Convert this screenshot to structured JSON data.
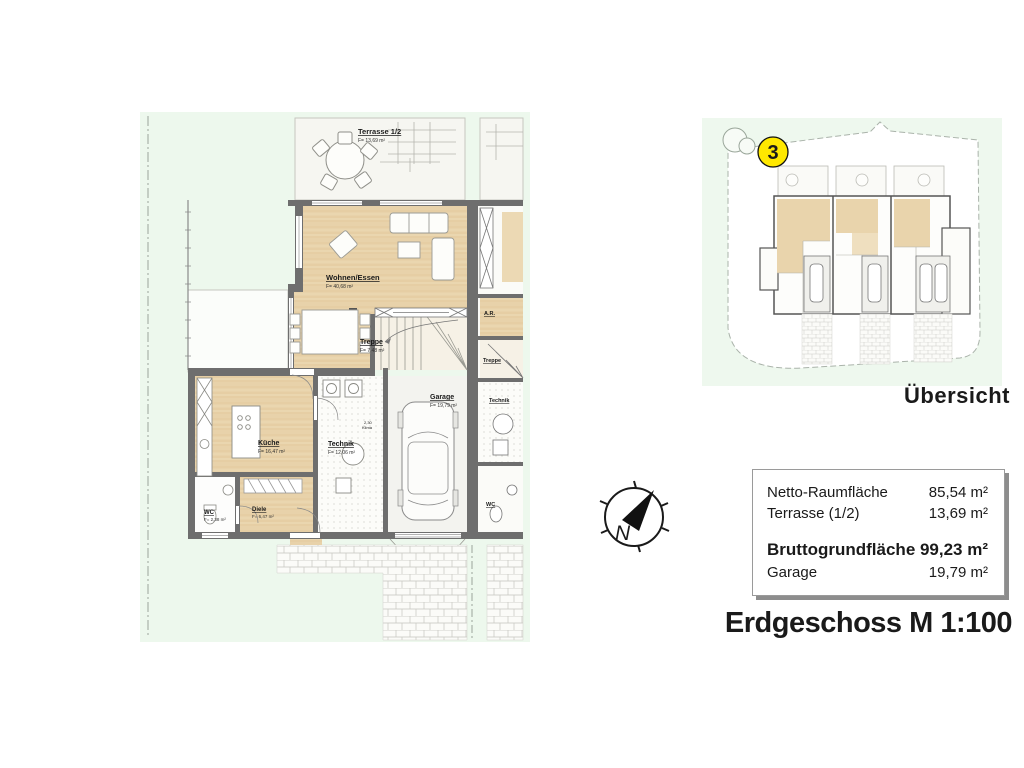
{
  "title": "Erdgeschoss M 1:100",
  "overview": {
    "badge": "3",
    "label": "Übersicht"
  },
  "compass": {
    "letter": "N"
  },
  "summary": {
    "rows": [
      {
        "label": "Netto-Raumfläche",
        "value": "85,54 m²"
      },
      {
        "label": "Terrasse (1/2)",
        "value": "13,69 m²"
      }
    ],
    "total": {
      "label": "Bruttogrundfläche",
      "value": "99,23 m²"
    },
    "garage": {
      "label": "Garage",
      "value": "19,79 m²"
    }
  },
  "floorplan": {
    "terrasse": {
      "name": "Terrasse 1/2",
      "area": "F= 13,69 m²"
    },
    "wohnen": {
      "name": "Wohnen/Essen",
      "area": "F= 40,68 m²"
    },
    "treppe": {
      "name": "Treppe",
      "area": "F= 7,48 m²"
    },
    "kueche": {
      "name": "Küche",
      "area": "F= 16,47 m²"
    },
    "technik": {
      "name": "Technik",
      "area": "F= 12,06 m²"
    },
    "garage": {
      "name": "Garage",
      "area": "F= 19,79 m²"
    },
    "wc": {
      "name": "WC",
      "area": "F= 2,38 m²"
    },
    "diele": {
      "name": "Diele",
      "area": "F= 6,47 m²"
    },
    "klima": {
      "value": "2,30",
      "label": "Klima"
    },
    "neighbor": {
      "ar": "A.R.",
      "treppe": "Treppe",
      "technik": "Technik",
      "wc": "WC"
    }
  },
  "colors": {
    "garden": "#edf8ed",
    "wood": "#e8d2aa",
    "wall": "#6e6e6e",
    "terrace": "#f6f6f1",
    "badge_yellow": "#ffe800"
  }
}
